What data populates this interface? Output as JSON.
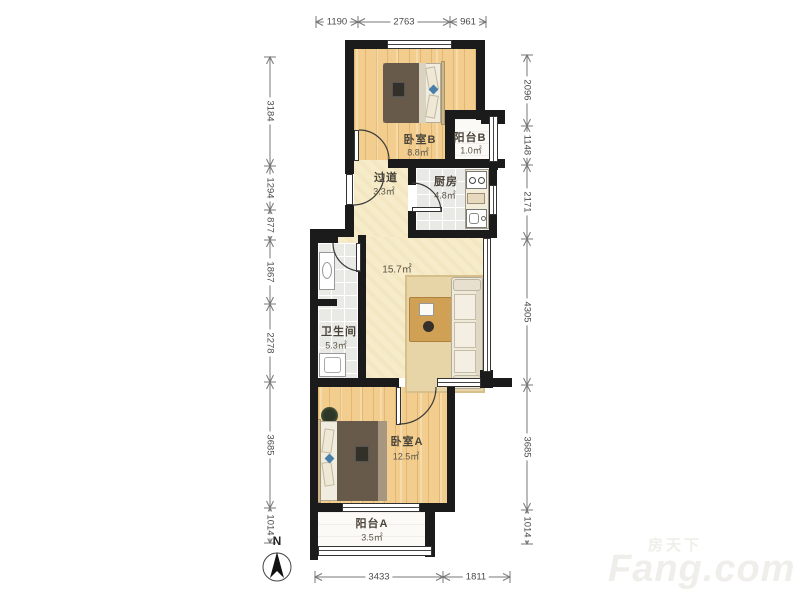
{
  "rooms": {
    "bedroom_b": {
      "name": "卧室B",
      "area": "8.8㎡"
    },
    "balcony_b": {
      "name": "阳台B",
      "area": "1.0㎡"
    },
    "corridor": {
      "name": "过道",
      "area": "3.3㎡"
    },
    "kitchen": {
      "name": "厨房",
      "area": "4.8㎡"
    },
    "living": {
      "area": "15.7㎡"
    },
    "bathroom": {
      "name": "卫生间",
      "area": "5.3㎡"
    },
    "bedroom_a": {
      "name": "卧室A",
      "area": "12.5㎡"
    },
    "balcony_a": {
      "name": "阳台A",
      "area": "3.5㎡"
    }
  },
  "dimensions_mm": {
    "top": [
      "1190",
      "2763",
      "961"
    ],
    "left": [
      "3184",
      "1294",
      "877",
      "1867",
      "2278",
      "3685",
      "1014"
    ],
    "right": [
      "2096",
      "1148",
      "2171",
      "4305",
      "3685",
      "1014"
    ],
    "bottom": [
      "3433",
      "1811"
    ]
  },
  "compass": {
    "label": "N"
  },
  "watermark": {
    "cn": "房天下",
    "en": "Fang.com"
  },
  "colors": {
    "wall": "#1b1b1b",
    "wood_floor": "#f2cd8e",
    "cream_floor": "#f6ecca",
    "tile_floor": "#e9e9e5",
    "accent_blue": "#4a7fa8",
    "table_tan": "#d0a055"
  }
}
